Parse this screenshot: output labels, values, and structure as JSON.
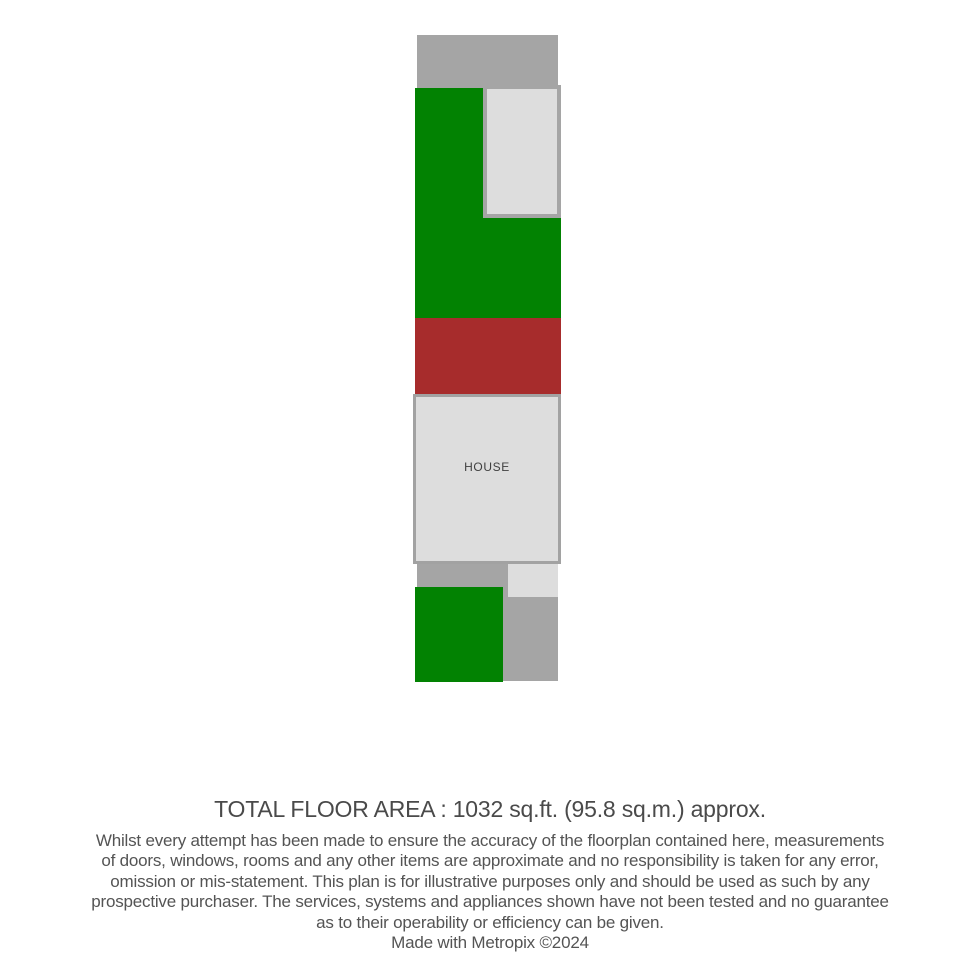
{
  "colors": {
    "garden_green": "#028202",
    "garage_red": "#a72c2c",
    "path_gray": "#a5a5a5",
    "house_fill": "#dddddd",
    "house_border": "#a2a2a2",
    "label_text": "#3f3f3f",
    "footer_text": "#545454"
  },
  "floorplan": {
    "house_label": "HOUSE",
    "regions": [
      {
        "name": "path-top",
        "x": 417,
        "y": 35,
        "w": 141,
        "h": 53,
        "fill": "#a5a5a5"
      },
      {
        "name": "garden-upper",
        "x": 415,
        "y": 88,
        "w": 146,
        "h": 230,
        "fill": "#028202"
      },
      {
        "name": "patio-inset",
        "x": 483,
        "y": 85,
        "w": 78,
        "h": 133,
        "fill": "#dddddd",
        "border": "4px solid #a5a5a5"
      },
      {
        "name": "garage-block",
        "x": 415,
        "y": 318,
        "w": 146,
        "h": 76,
        "fill": "#a72c2c"
      },
      {
        "name": "house",
        "x": 413,
        "y": 394,
        "w": 148,
        "h": 170,
        "fill": "#dddddd",
        "border": "3px solid #a2a2a2",
        "label": "HOUSE"
      },
      {
        "name": "path-bottom",
        "x": 417,
        "y": 564,
        "w": 141,
        "h": 117,
        "fill": "#a5a5a5"
      },
      {
        "name": "house-extension",
        "x": 508,
        "y": 564,
        "w": 50,
        "h": 33,
        "fill": "#dddddd"
      },
      {
        "name": "garden-lower",
        "x": 415,
        "y": 587,
        "w": 88,
        "h": 95,
        "fill": "#028202"
      }
    ]
  },
  "footer": {
    "total_area": "TOTAL FLOOR AREA : 1032 sq.ft. (95.8 sq.m.) approx.",
    "disclaimer_lines": [
      "Whilst every attempt has been made to ensure the accuracy of the floorplan contained here, measurements",
      "of doors, windows, rooms and any other items are approximate and no responsibility is taken for any error,",
      "omission or mis-statement. This plan is for illustrative purposes only and should be used as such by any",
      "prospective purchaser. The services, systems and appliances shown have not been tested and no guarantee",
      "as to their operability or efficiency can be given."
    ],
    "credit": "Made with Metropix ©2024"
  }
}
